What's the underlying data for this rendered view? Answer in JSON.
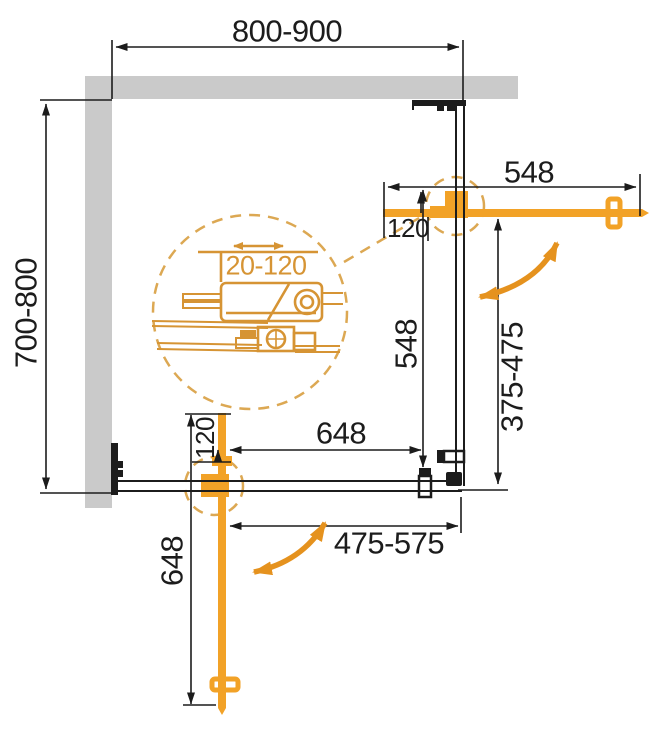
{
  "dims": {
    "top_width": "800-900",
    "left_depth": "700-800",
    "right_door_length": "548",
    "right_door_inset": "120",
    "side_panel_depth": "548",
    "right_opening_range": "375-475",
    "bottom_panel_width": "648",
    "bottom_door_inset": "120",
    "bottom_door_length": "648",
    "bottom_opening_range": "475-575",
    "profile_adjustment_range": "20-120"
  },
  "colors": {
    "wall_gray": "#cacaca",
    "line_black": "#1c1c1c",
    "door_orange": "#F2A227",
    "swing_arrow_orange": "#E5921E",
    "detail_orange": "#D69434",
    "detail_dash_orange": "#DCA853"
  }
}
